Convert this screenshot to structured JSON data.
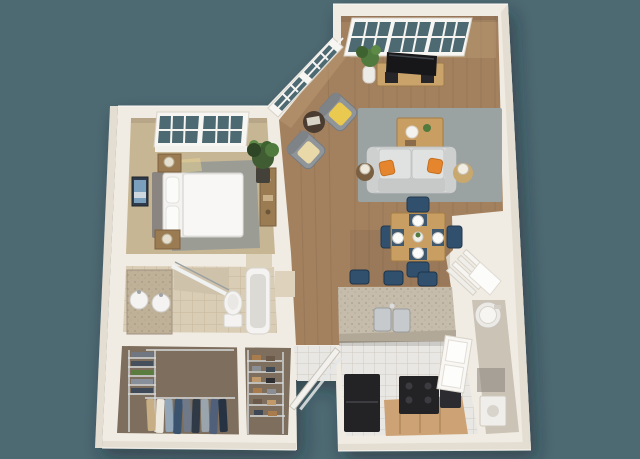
{
  "scene": {
    "kind": "3d-floorplan-render",
    "view": "isometric-top-down",
    "unit": "one-bedroom-apartment",
    "colors": {
      "background": "#4d6972",
      "wall": "#f0ece3",
      "wall_shade": "#e4ded2",
      "wall_edge": "#d8d2c6",
      "wood_floor": "#a3815f",
      "carpet": "#c7b694",
      "bed_rug": "#9b9c94",
      "living_rug": "#9ba3a4",
      "bath_floor": "#d9cdb6",
      "tile": "#e9e7e3",
      "closet_floor": "#7d6e5d",
      "granite": "#c5bcab",
      "navy": "#31506e",
      "appliance": "#232326",
      "cabinet": "#cda376",
      "furniture_wood": "#c99e63",
      "dresser": "#9a7b52",
      "fixture": "#f4f3f1",
      "glass": "#4d6972",
      "plant": "#517a3e",
      "sofa": "#d7d9d8",
      "armchair": "#90959a",
      "pillow": "#e5862f",
      "throw_yellow": "#e9c94f",
      "throw_cream": "#ead9a8"
    },
    "rooms": [
      {
        "id": "bedroom",
        "furniture": [
          "window",
          "bed",
          "headboard",
          "pillows",
          "nightstand-left",
          "nightstand-right",
          "table-lamps",
          "area-rug",
          "wall-art",
          "plant",
          "dresser"
        ]
      },
      {
        "id": "living-room",
        "furniture": [
          "picture-windows",
          "diagonal-windows",
          "tv",
          "tv-console",
          "potted-plant",
          "area-rug",
          "coffee-table",
          "sofa",
          "accent-pillows",
          "side-table-lamps",
          "armchair-1",
          "armchair-2",
          "round-table",
          "floor-plant"
        ]
      },
      {
        "id": "dining-area",
        "furniture": [
          "dining-table",
          "dining-chairs",
          "place-settings"
        ]
      },
      {
        "id": "kitchen",
        "furniture": [
          "breakfast-bar",
          "double-sink",
          "bar-stools",
          "refrigerator",
          "range",
          "base-cabinets",
          "window"
        ]
      },
      {
        "id": "bathroom",
        "furniture": [
          "vanity",
          "double-sinks",
          "shower-glass",
          "toilet",
          "bathtub"
        ]
      },
      {
        "id": "walk-in-closet",
        "furniture": [
          "wire-shelves",
          "folded-clothes",
          "hanging-clothes",
          "shoe-rack"
        ]
      },
      {
        "id": "entry",
        "furniture": [
          "tile-floor",
          "open-door"
        ]
      },
      {
        "id": "utility-closet",
        "furniture": [
          "water-heater",
          "washer"
        ]
      },
      {
        "id": "corner-pantry",
        "furniture": [
          "angled-shelves"
        ]
      }
    ]
  }
}
